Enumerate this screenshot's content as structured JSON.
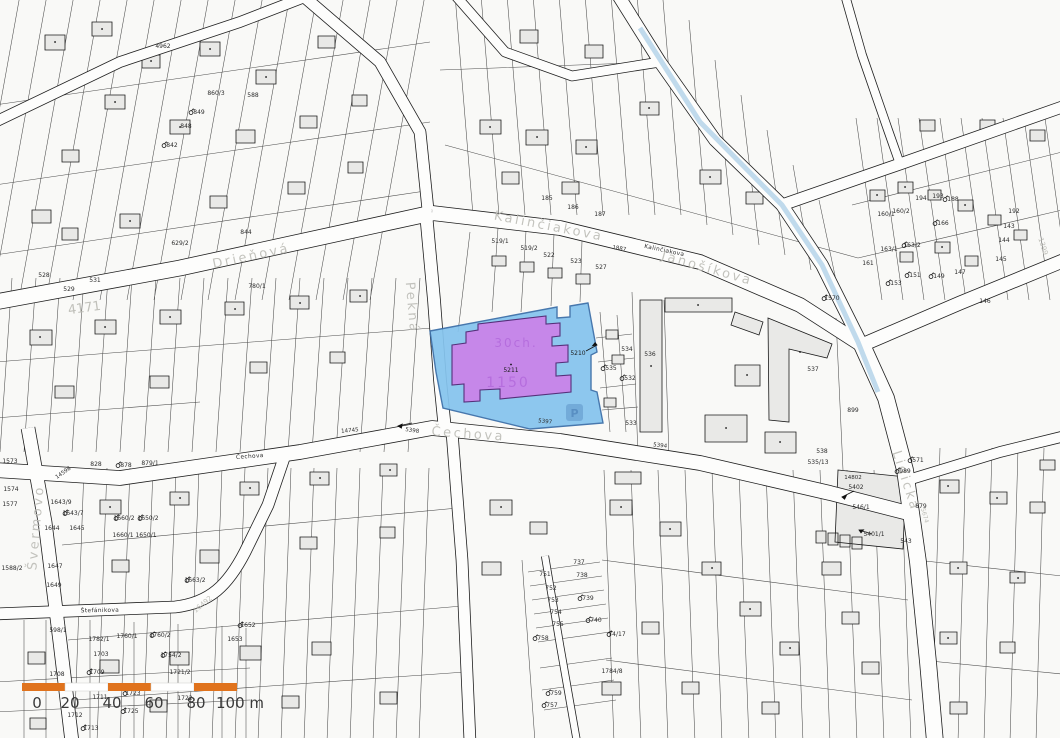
{
  "colors": {
    "background": "#f9f9f7",
    "street_fill": "#fdfdfc",
    "casing": "#1f1f1f",
    "building_fill": "#e9e9e7",
    "stream": "#b9d6ea",
    "street_label": "#bdbdb7"
  },
  "highlight": {
    "parcel_number": "5211",
    "adjacent_parcel_number": "5210",
    "watermark_line1": "30ch.",
    "watermark_line2": "1150",
    "parking_symbol": "P",
    "area_fill": "#85c4ee",
    "area_stroke": "#3a6ea8",
    "building_fill": "#c687e9",
    "building_stroke": "#55307a"
  },
  "scalebar": {
    "bar_color": "#e0731d",
    "unit_labels": [
      {
        "t": "0",
        "x": 37
      },
      {
        "t": "20",
        "x": 70
      },
      {
        "t": "40",
        "x": 112
      },
      {
        "t": "60",
        "x": 154
      },
      {
        "t": "80",
        "x": 196
      },
      {
        "t": "100 m",
        "x": 240
      }
    ]
  },
  "street_labels": [
    {
      "t": "Drieňová",
      "x": 252,
      "y": 260,
      "r": -12
    },
    {
      "t": "Kalinčiakova",
      "x": 548,
      "y": 230,
      "r": 11
    },
    {
      "t": "Kalinčiakova",
      "x": 664,
      "y": 252,
      "r": 12,
      "small": true
    },
    {
      "t": "Čechova",
      "x": 468,
      "y": 438,
      "r": 4
    },
    {
      "t": "Čechova",
      "x": 250,
      "y": 458,
      "r": -4,
      "small": true
    },
    {
      "t": "Švermovo",
      "x": 40,
      "y": 528,
      "r": -85
    },
    {
      "t": "Lidická",
      "x": 902,
      "y": 482,
      "r": 72
    },
    {
      "t": "Janošíkova",
      "x": 706,
      "y": 272,
      "r": 16
    },
    {
      "t": "Štefánikova",
      "x": 100,
      "y": 612,
      "r": -1,
      "small": true
    },
    {
      "t": "Pekná",
      "x": 408,
      "y": 308,
      "r": 85
    }
  ],
  "road_numbers": [
    {
      "t": "4171",
      "x": 85,
      "y": 312,
      "r": -8,
      "fs": 13
    },
    {
      "t": "16492",
      "x": 204,
      "y": 606,
      "r": -40,
      "fs": 7
    },
    {
      "t": "1399",
      "x": 1041,
      "y": 247,
      "r": 72,
      "fs": 7
    },
    {
      "t": "5674",
      "x": 923,
      "y": 516,
      "r": 74,
      "fs": 6
    },
    {
      "t": "14598",
      "x": 64,
      "y": 474,
      "r": -35,
      "fs": 5.5,
      "dark": true
    },
    {
      "t": "5397",
      "x": 545,
      "y": 423,
      "r": 6,
      "fs": 5.5,
      "dark": true
    },
    {
      "t": "5398",
      "x": 412,
      "y": 432,
      "r": 8,
      "fs": 5.5,
      "dark": true
    },
    {
      "t": "5394",
      "x": 660,
      "y": 447,
      "r": 6,
      "fs": 5.5,
      "dark": true
    },
    {
      "t": "14745",
      "x": 350,
      "y": 432,
      "r": -5,
      "fs": 5.5,
      "dark": true
    },
    {
      "t": "14802",
      "x": 853,
      "y": 479,
      "r": 0,
      "fs": 5.5,
      "dark": true
    },
    {
      "t": "1887",
      "x": 619,
      "y": 250,
      "r": 10,
      "fs": 5.5,
      "dark": true
    }
  ],
  "parcel_labels": [
    {
      "t": "528",
      "x": 44,
      "y": 277
    },
    {
      "t": "529",
      "x": 69,
      "y": 291
    },
    {
      "t": "531",
      "x": 95,
      "y": 282
    },
    {
      "t": "4962",
      "x": 163,
      "y": 48
    },
    {
      "t": "849",
      "x": 199,
      "y": 114,
      "s": 1
    },
    {
      "t": "848",
      "x": 186,
      "y": 128
    },
    {
      "t": "842",
      "x": 172,
      "y": 147,
      "s": 1
    },
    {
      "t": "860/3",
      "x": 216,
      "y": 95
    },
    {
      "t": "588",
      "x": 253,
      "y": 97
    },
    {
      "t": "629/2",
      "x": 180,
      "y": 245
    },
    {
      "t": "844",
      "x": 246,
      "y": 234
    },
    {
      "t": "780/1",
      "x": 257,
      "y": 288
    },
    {
      "t": "519/1",
      "x": 500,
      "y": 243
    },
    {
      "t": "519/2",
      "x": 529,
      "y": 250
    },
    {
      "t": "522",
      "x": 549,
      "y": 257
    },
    {
      "t": "523",
      "x": 576,
      "y": 263
    },
    {
      "t": "527",
      "x": 601,
      "y": 269
    },
    {
      "t": "185",
      "x": 547,
      "y": 200
    },
    {
      "t": "186",
      "x": 573,
      "y": 209
    },
    {
      "t": "187",
      "x": 600,
      "y": 216
    },
    {
      "t": "536",
      "x": 650,
      "y": 356
    },
    {
      "t": "537",
      "x": 813,
      "y": 371
    },
    {
      "t": "534",
      "x": 627,
      "y": 351
    },
    {
      "t": "535",
      "x": 611,
      "y": 370,
      "s": 1
    },
    {
      "t": "532",
      "x": 630,
      "y": 380,
      "s": 1
    },
    {
      "t": "533",
      "x": 631,
      "y": 425
    },
    {
      "t": "1570",
      "x": 832,
      "y": 300,
      "s": 1
    },
    {
      "t": "899",
      "x": 853,
      "y": 412
    },
    {
      "t": "538",
      "x": 822,
      "y": 453
    },
    {
      "t": "535/13",
      "x": 818,
      "y": 464
    },
    {
      "t": "571",
      "x": 918,
      "y": 462,
      "s": 1
    },
    {
      "t": "989",
      "x": 905,
      "y": 473,
      "s": 1
    },
    {
      "t": "879",
      "x": 921,
      "y": 508
    },
    {
      "t": "543",
      "x": 906,
      "y": 543
    },
    {
      "t": "546/1",
      "x": 861,
      "y": 509
    },
    {
      "t": "5402",
      "x": 856,
      "y": 489
    },
    {
      "t": "5401/1",
      "x": 874,
      "y": 536
    },
    {
      "t": "160/1",
      "x": 886,
      "y": 216
    },
    {
      "t": "160/2",
      "x": 901,
      "y": 213
    },
    {
      "t": "163/1",
      "x": 889,
      "y": 251
    },
    {
      "t": "163/2",
      "x": 912,
      "y": 247,
      "s": 1
    },
    {
      "t": "161",
      "x": 868,
      "y": 265
    },
    {
      "t": "166",
      "x": 943,
      "y": 225,
      "s": 1
    },
    {
      "t": "194",
      "x": 921,
      "y": 200
    },
    {
      "t": "193",
      "x": 938,
      "y": 198
    },
    {
      "t": "188",
      "x": 953,
      "y": 201,
      "s": 1
    },
    {
      "t": "192",
      "x": 1014,
      "y": 213
    },
    {
      "t": "143",
      "x": 1009,
      "y": 228
    },
    {
      "t": "144",
      "x": 1004,
      "y": 242
    },
    {
      "t": "145",
      "x": 1001,
      "y": 261
    },
    {
      "t": "146",
      "x": 985,
      "y": 303
    },
    {
      "t": "147",
      "x": 960,
      "y": 274
    },
    {
      "t": "149",
      "x": 939,
      "y": 278,
      "s": 1
    },
    {
      "t": "151",
      "x": 915,
      "y": 277,
      "s": 1
    },
    {
      "t": "153",
      "x": 896,
      "y": 285,
      "s": 1
    },
    {
      "t": "737",
      "x": 579,
      "y": 564
    },
    {
      "t": "738",
      "x": 582,
      "y": 577
    },
    {
      "t": "739",
      "x": 588,
      "y": 600,
      "s": 1
    },
    {
      "t": "740",
      "x": 596,
      "y": 622,
      "s": 1
    },
    {
      "t": "751",
      "x": 545,
      "y": 576
    },
    {
      "t": "752",
      "x": 551,
      "y": 590
    },
    {
      "t": "753",
      "x": 553,
      "y": 602
    },
    {
      "t": "754",
      "x": 556,
      "y": 614
    },
    {
      "t": "755",
      "x": 558,
      "y": 626
    },
    {
      "t": "758",
      "x": 543,
      "y": 640,
      "s": 1
    },
    {
      "t": "759",
      "x": 556,
      "y": 695,
      "s": 1
    },
    {
      "t": "757",
      "x": 552,
      "y": 707,
      "s": 1
    },
    {
      "t": "74/17",
      "x": 617,
      "y": 636,
      "s": 1
    },
    {
      "t": "1784/8",
      "x": 612,
      "y": 673
    },
    {
      "t": "1643/9",
      "x": 61,
      "y": 504
    },
    {
      "t": "1643/7",
      "x": 73,
      "y": 515,
      "s": 1
    },
    {
      "t": "1644",
      "x": 52,
      "y": 530
    },
    {
      "t": "1645",
      "x": 77,
      "y": 530
    },
    {
      "t": "1647",
      "x": 55,
      "y": 568
    },
    {
      "t": "1649",
      "x": 54,
      "y": 587
    },
    {
      "t": "1660/2",
      "x": 124,
      "y": 520,
      "s": 1
    },
    {
      "t": "1660/1",
      "x": 123,
      "y": 537
    },
    {
      "t": "1650/2",
      "x": 148,
      "y": 520,
      "s": 1
    },
    {
      "t": "1650/1",
      "x": 146,
      "y": 537
    },
    {
      "t": "1577",
      "x": 10,
      "y": 506
    },
    {
      "t": "1573",
      "x": 10,
      "y": 463
    },
    {
      "t": "1574",
      "x": 11,
      "y": 491
    },
    {
      "t": "1588/2",
      "x": 12,
      "y": 570
    },
    {
      "t": "828",
      "x": 96,
      "y": 466
    },
    {
      "t": "878",
      "x": 126,
      "y": 467,
      "s": 1
    },
    {
      "t": "879/1",
      "x": 150,
      "y": 465
    },
    {
      "t": "598/1",
      "x": 58,
      "y": 632
    },
    {
      "t": "1782/1",
      "x": 99,
      "y": 641
    },
    {
      "t": "1703",
      "x": 101,
      "y": 656
    },
    {
      "t": "1760/1",
      "x": 127,
      "y": 638
    },
    {
      "t": "1760/2",
      "x": 160,
      "y": 637,
      "s": 1
    },
    {
      "t": "1754/2",
      "x": 171,
      "y": 657,
      "s": 1
    },
    {
      "t": "1652",
      "x": 248,
      "y": 627,
      "s": 1
    },
    {
      "t": "1653",
      "x": 235,
      "y": 641
    },
    {
      "t": "1663/2",
      "x": 195,
      "y": 582,
      "s": 1
    },
    {
      "t": "1708",
      "x": 57,
      "y": 676
    },
    {
      "t": "1709",
      "x": 97,
      "y": 674,
      "s": 1
    },
    {
      "t": "1721/2",
      "x": 180,
      "y": 674
    },
    {
      "t": "1711",
      "x": 100,
      "y": 699
    },
    {
      "t": "1723",
      "x": 133,
      "y": 695,
      "s": 1
    },
    {
      "t": "1725",
      "x": 131,
      "y": 713,
      "s": 1
    },
    {
      "t": "1712",
      "x": 75,
      "y": 717
    },
    {
      "t": "1713",
      "x": 91,
      "y": 730,
      "s": 1
    },
    {
      "t": "1722",
      "x": 185,
      "y": 700
    }
  ]
}
